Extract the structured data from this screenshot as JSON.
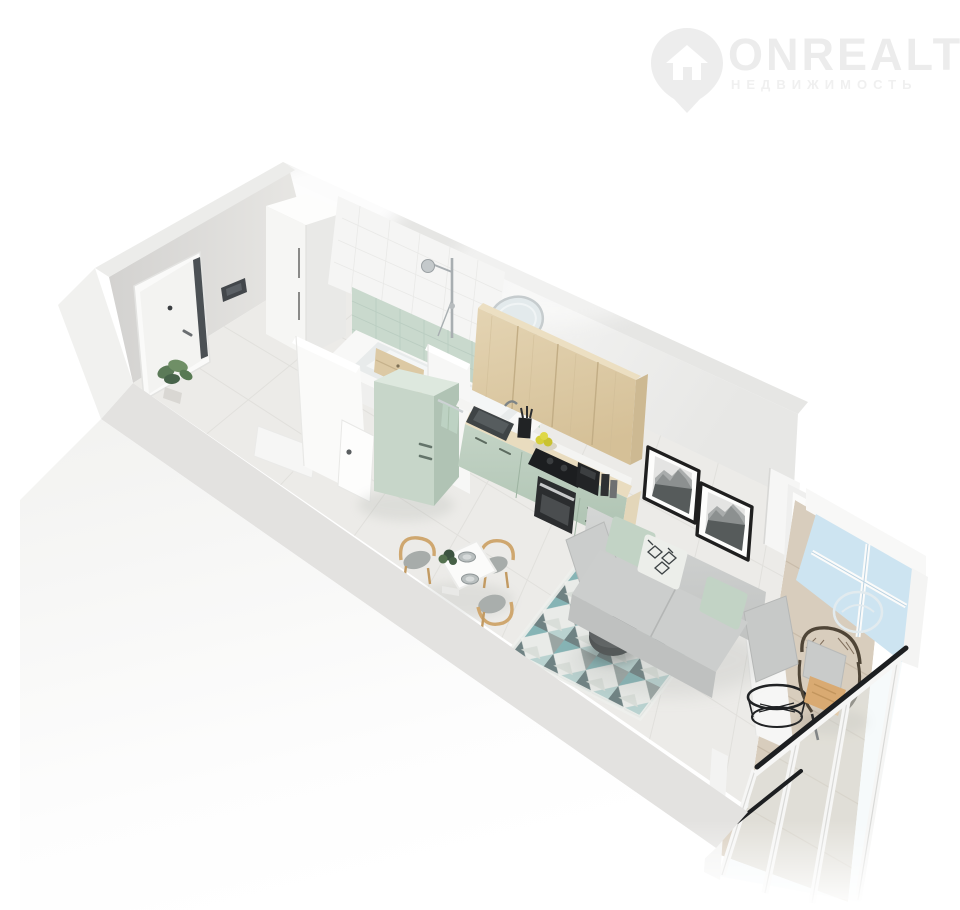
{
  "page": {
    "type": "3d-floorplan-render",
    "background": "#ffffff",
    "description": "Isometric 3D render of a studio apartment with open cut-away walls"
  },
  "watermark": {
    "brand": "ONREALT",
    "tagline": "НЕДВИЖИМОСТЬ",
    "icon": "house-location-pin-icon",
    "brand_color": "#ececec",
    "tagline_color": "#f0f0f0"
  },
  "scene": {
    "rooms": [
      {
        "name": "hallway",
        "items": [
          "entrance-door",
          "intercom-panel",
          "wardrobe",
          "plant",
          "floor-mat"
        ]
      },
      {
        "name": "bathroom",
        "items": [
          "bathtub",
          "shower-set",
          "round-mirror",
          "vanity-sink",
          "mint-tile-wall",
          "bathroom-door",
          "storage-drawers"
        ]
      },
      {
        "name": "kitchen",
        "items": [
          "mint-fridge",
          "wood-upper-cabinets",
          "mint-counter",
          "sink",
          "cooktop",
          "oven",
          "coffee-machine",
          "towel",
          "lemons",
          "utensil-cup"
        ]
      },
      {
        "name": "dining",
        "items": [
          "white-table",
          "wood-chairs",
          "plates",
          "table-plant"
        ]
      },
      {
        "name": "living",
        "items": [
          "gray-sofa",
          "mint-pillows",
          "patterned-pillow",
          "geometric-rug",
          "round-coffee-table",
          "framed-wall-art"
        ]
      },
      {
        "name": "balcony",
        "items": [
          "glass-wall",
          "black-railing",
          "rattan-armchair",
          "wire-table",
          "wood-plank-floor",
          "parapet"
        ]
      }
    ],
    "palette": {
      "mint": "#c7d6c9",
      "mint_tile": "#c9d9cd",
      "wood": "#ddcba8",
      "counter_wood": "#e9dcbf",
      "sofa_gray": "#cdcfce",
      "rug_teal": "#86b4b5",
      "glass_blue": "#cde4f1",
      "floor": "#ecebe8",
      "balcony_wood": "#d8cdbd",
      "wall_light": "#efefee",
      "railing_black": "#1d1f21",
      "frame_black": "#1f1f1f"
    }
  }
}
